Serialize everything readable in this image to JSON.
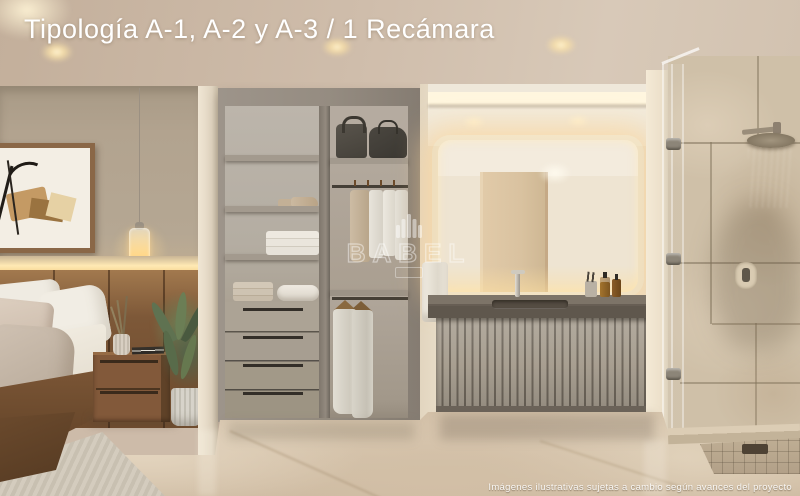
{
  "title": {
    "text": "Tipología A-1, A-2 y A-3 / 1 Recámara",
    "color": "#ffffff"
  },
  "watermark": {
    "brand": "BABEL",
    "icon": "babel-tower-icon"
  },
  "footer": {
    "disclaimer": "Imágenes ilustrativas sujetas a cambio según avances del proyecto"
  },
  "scene": {
    "rooms": [
      "bedroom",
      "walk-in-closet",
      "bathroom-vanity",
      "shower"
    ],
    "palette": {
      "ceiling": "#ccbbaa",
      "bedroom_wall": "#b2a38f",
      "headboard_wood": "#7d5838",
      "led_glow": "#ffe9b4",
      "closet_frame": "#958c81",
      "closet_back": "#b9b2a8",
      "drawer_front": "#a79e91",
      "bath_wall": "#e9ddc8",
      "countertop": "#675e54",
      "vanity_slats": "#a49b8d",
      "travertine": "#cfc0a8",
      "marble_floor": "#d8c7b0",
      "mirror_glow": "#ffd99c"
    }
  }
}
